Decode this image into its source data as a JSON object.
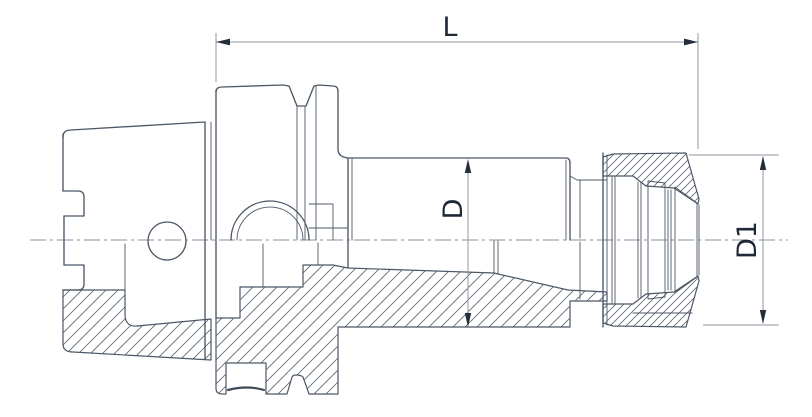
{
  "drawing": {
    "labels": {
      "length": "L",
      "body_diameter": "D",
      "nose_diameter": "D1"
    },
    "colors": {
      "outline": "#4d5866",
      "dimension_line": "#8f959e",
      "centerline": "#8a919c",
      "arrow_and_text": "#242d3a",
      "hatch": "#5d6673",
      "background": "#ffffff"
    }
  }
}
